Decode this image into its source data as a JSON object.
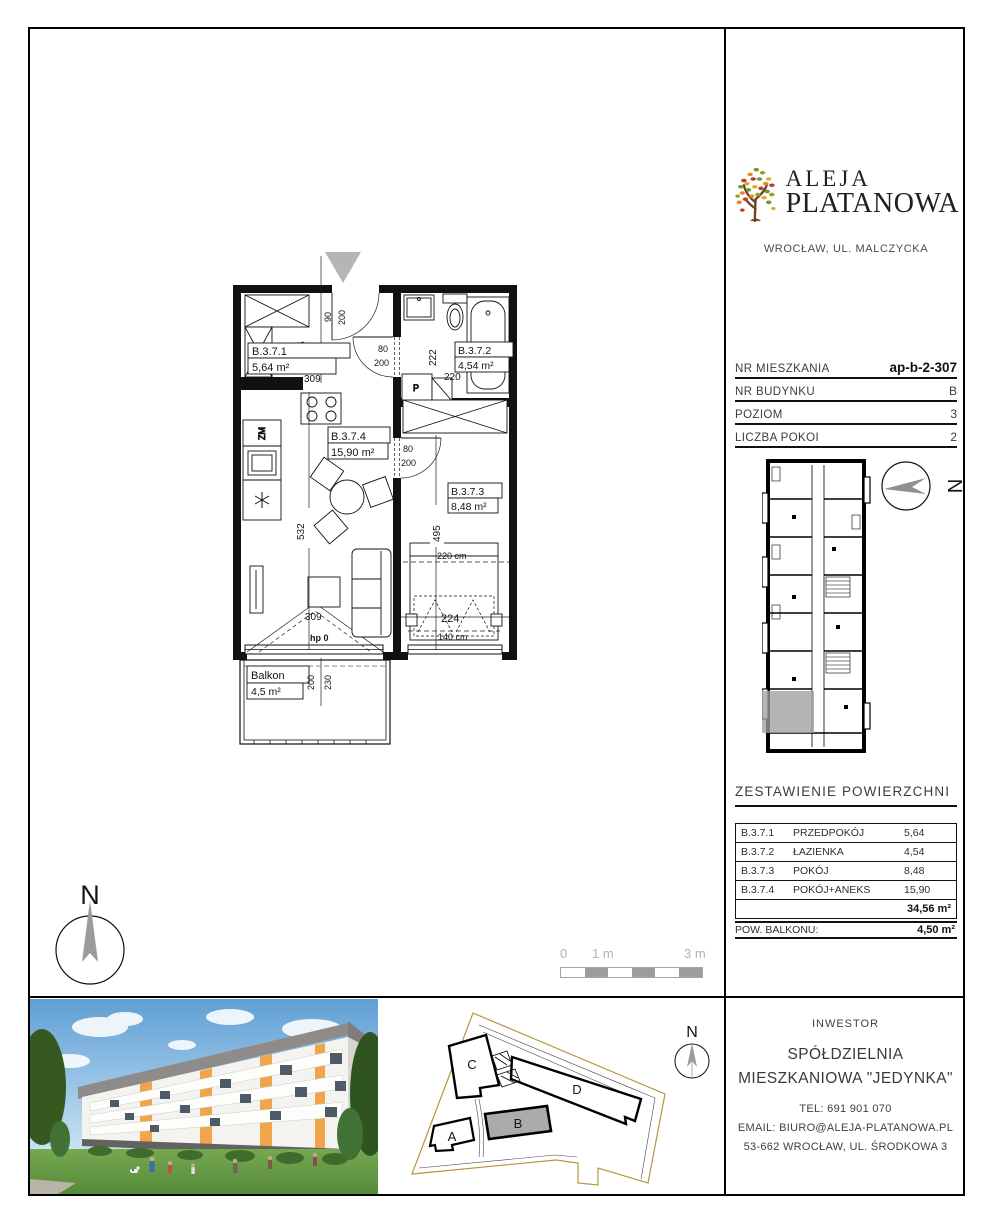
{
  "logo": {
    "name_line1": "ALEJA",
    "name_line2": "PLATANOWA",
    "location": "WROCŁAW, UL. MALCZYCKA"
  },
  "unit_info": {
    "rows": [
      {
        "label": "NR MIESZKANIA",
        "value": "ap-b-2-307"
      },
      {
        "label": "NR BUDYNKU",
        "value": "B"
      },
      {
        "label": "POZIOM",
        "value": "3"
      },
      {
        "label": "LICZBA POKOI",
        "value": "2"
      }
    ]
  },
  "area_table": {
    "heading": "ZESTAWIENIE POWIERZCHNI",
    "rows": [
      {
        "code": "B.3.7.1",
        "name": "PRZEDPOKÓJ",
        "value": "5,64"
      },
      {
        "code": "B.3.7.2",
        "name": "ŁAZIENKA",
        "value": "4,54"
      },
      {
        "code": "B.3.7.3",
        "name": "POKÓJ",
        "value": "8,48"
      },
      {
        "code": "B.3.7.4",
        "name": "POKÓJ+ANEKS",
        "value": "15,90"
      }
    ],
    "total": "34,56 m²",
    "balcony_label": "POW. BALKONU:",
    "balcony_value": "4,50 m²"
  },
  "floor_plan": {
    "labels": {
      "r1_code": "B.3.7.1",
      "r1_area": "5,64 m²",
      "r2_code": "B.3.7.2",
      "r2_area": "4,54 m²",
      "r3_code": "B.3.7.3",
      "r3_area": "8,48 m²",
      "r4_code": "B.3.7.4",
      "r4_area": "15,90 m²",
      "balcony_name": "Balkon",
      "balcony_area": "4,5 m²"
    },
    "dims": {
      "entry_w": "90",
      "entry_h": "200",
      "hall_d": "185",
      "hall_w": "309",
      "bathdoor_w": "80",
      "bathdoor_h": "200",
      "bath_d": "222",
      "bath_w": "220",
      "living_d": "532",
      "living_w": "309",
      "beddoor_w": "80",
      "beddoor_h": "200",
      "bed_d": "495",
      "bed_w": "224",
      "bed_len": "220 cm",
      "bed_wid": "140 cm",
      "sill": "hp 0",
      "balc_1": "200",
      "balc_2": "230"
    },
    "fixtures": {
      "dishwasher": "ZM",
      "washer": "P"
    }
  },
  "scale_bar": {
    "tick_0": "0",
    "tick_1": "1 m",
    "tick_3": "3 m"
  },
  "north": {
    "letter": "N"
  },
  "site_plan": {
    "building_a": "A",
    "building_b": "B",
    "building_c": "C",
    "building_d": "D"
  },
  "investor": {
    "heading": "INWESTOR",
    "name_line1": "SPÓŁDZIELNIA",
    "name_line2": "MIESZKANIOWA \"JEDYNKA\"",
    "phone": "TEL:  691 901 070",
    "email": "EMAIL: BIURO@ALEJA-PLATANOWA.PL",
    "address": "53-662 WROCŁAW, UL. ŚRODKOWA 3"
  },
  "colors": {
    "highlight_gray": "#a0a0a0",
    "boundary_tan": "#b5953f",
    "accent_orange": "#f0a44c",
    "leaf_green": "#6d9a2f",
    "leaf_red": "#c0392b",
    "leaf_yellow": "#e3aa2e",
    "trunk_brown": "#6b4423"
  }
}
